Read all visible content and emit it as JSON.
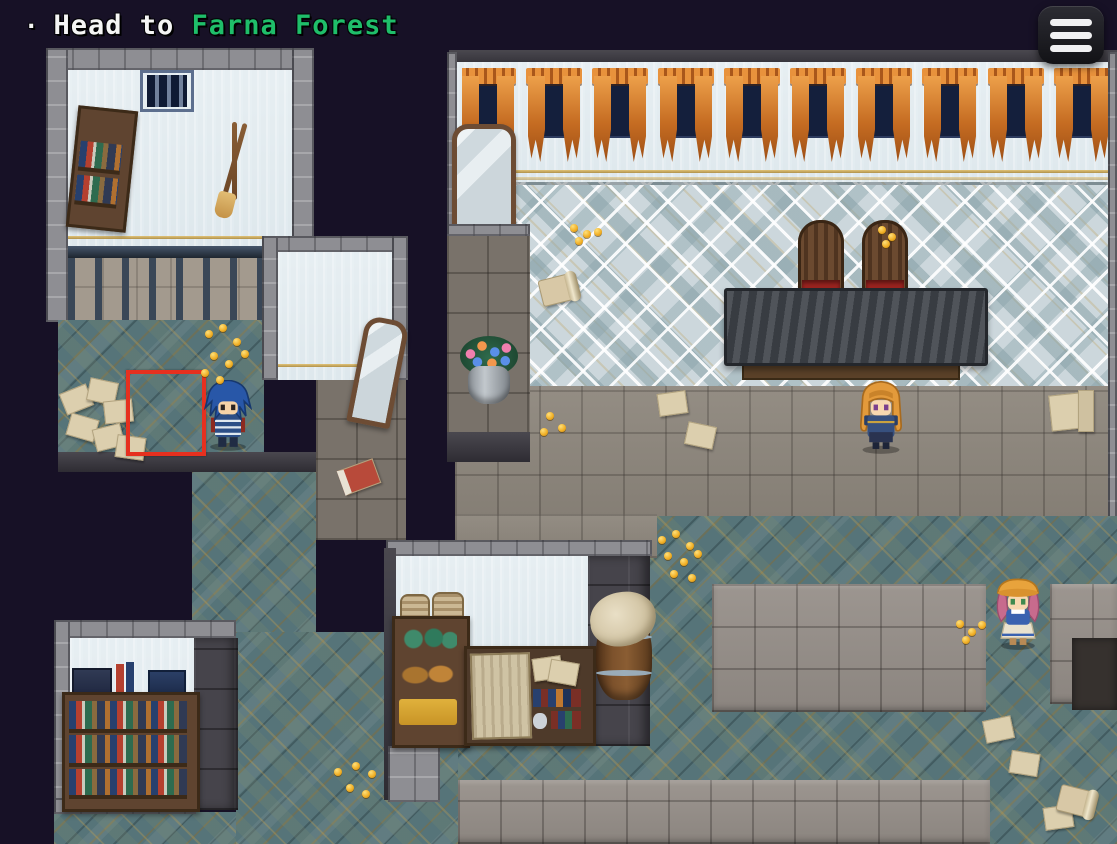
{
  "hud": {
    "quest": {
      "bullet": "·",
      "prefix": "Head to",
      "target": "Farna Forest"
    },
    "menu_button": {
      "icon": "hamburger-menu-icon",
      "line_count": 3
    }
  },
  "hall": {
    "window_count": 10
  },
  "palette": {
    "void": "#171126",
    "quest_text": "#f5f5f5",
    "quest_target": "#1fbe6a",
    "cursor_red": "#e6301f",
    "coin_gold": "#f2b32e",
    "teal_floor": "#567479",
    "stone_floor": "#8d867c",
    "diamond_floor": "#ccd7dc",
    "wall_light": "#c2ccd2",
    "wall_stone": "#8e8e93",
    "wall_dark": "#46444b",
    "wood": "#5f4430",
    "curtain_orange": "#d4762b",
    "window_navy": "#141f3c",
    "table_top": "#43474e",
    "throne_seat": "#9e2420"
  },
  "entities": {
    "player": {
      "role": "player-character",
      "hair_color": "#2857a8",
      "facing": "down"
    },
    "npc_knight": {
      "role": "npc",
      "hair_color": "#e39a3b"
    },
    "npc_villager": {
      "role": "npc",
      "hair_color": "#c76b8d"
    }
  }
}
